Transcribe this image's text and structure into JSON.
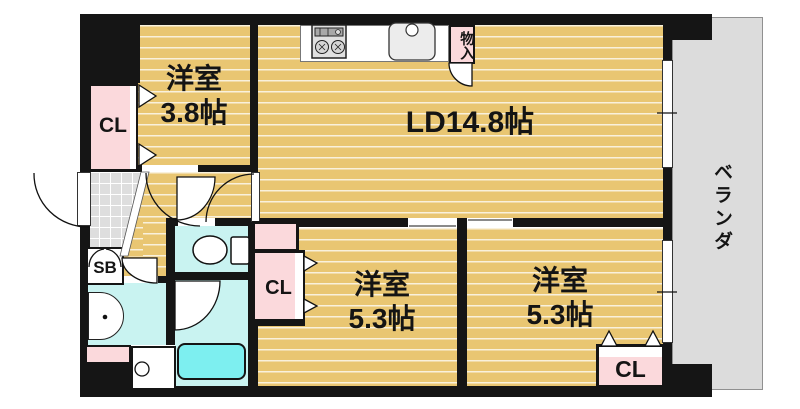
{
  "rooms": {
    "living": {
      "label": "LD14.8帖"
    },
    "bedroom_top": {
      "name": "洋室",
      "size": "3.8帖"
    },
    "bedroom_left": {
      "name": "洋室",
      "size": "5.3帖"
    },
    "bedroom_right": {
      "name": "洋室",
      "size": "5.3帖"
    }
  },
  "storage": {
    "closet_top_left": {
      "label": "CL"
    },
    "closet_middle": {
      "label": "CL"
    },
    "closet_bottom_right": {
      "label": "CL"
    },
    "shoe_box": {
      "label": "SB"
    },
    "hall_storage": {
      "label": "物入"
    }
  },
  "balcony": {
    "label": "ベランダ"
  },
  "icons": [
    "stove-icon",
    "kitchen-sink-icon",
    "toilet-icon",
    "bathtub-icon",
    "washbasin-icon",
    "washing-machine-icon",
    "folding-door-icon",
    "door-arc-icon",
    "sliding-window-icon"
  ],
  "colors": {
    "flooring": "#e9c672",
    "closet_pink": "#fbd9dc",
    "wet_floor": "#c9f3f1",
    "bathtub": "#7deff0",
    "genkan_tile": "#dedede",
    "balcony_gray": "#dcdcdc",
    "wall": "#151515"
  }
}
